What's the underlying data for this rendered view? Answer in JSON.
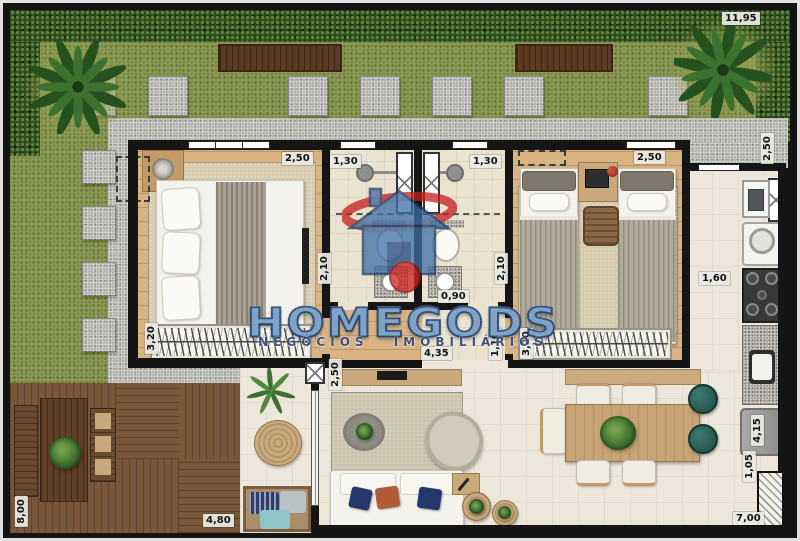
{
  "watermark": {
    "brand": "HOMEGODS",
    "subtitle": "NEGÓCIOS IMOBILIÁRIOS",
    "colors": {
      "blue": "#4a76a4",
      "dark_blue": "#1c3a66",
      "red": "#c52020"
    }
  },
  "dimensions": {
    "lot_top": "11,95",
    "side_right": "2,50",
    "bedroom1_width": "2,50",
    "bath1_width": "1,30",
    "bath2_width": "1,30",
    "bedroom2_width": "2,50",
    "bath1_depth": "2,10",
    "bath2_depth": "2,10",
    "hall_width": "0,90",
    "bedroom1_length": "4,35",
    "hall_depth": "1,10",
    "wardrobe1_width": "3,20",
    "wardrobe2_width": "3,20",
    "kitchen_width": "1,60",
    "terrace_opening": "2,50",
    "kitchen_length": "4,15",
    "kitchen_clear": "1,05",
    "deck_depth": "8,00",
    "deck_width": "4,80",
    "patio_width": "7,00"
  }
}
